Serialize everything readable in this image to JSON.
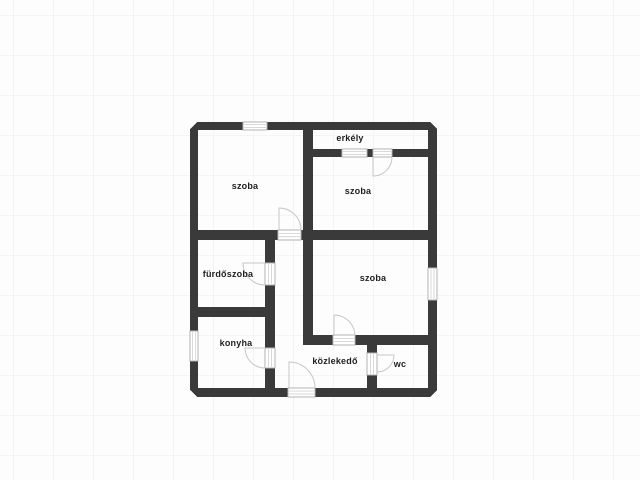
{
  "floor_plan": {
    "rooms": [
      {
        "name": "szoba-top-left",
        "label": "szoba"
      },
      {
        "name": "erkely",
        "label": "erkély"
      },
      {
        "name": "szoba-top-right",
        "label": "szoba"
      },
      {
        "name": "szoba-middle",
        "label": "szoba"
      },
      {
        "name": "furdoszoba",
        "label": "fürdőszoba"
      },
      {
        "name": "konyha",
        "label": "konyha"
      },
      {
        "name": "kozlekedo",
        "label": "közlekedő"
      },
      {
        "name": "wc",
        "label": "wc"
      }
    ],
    "colors": {
      "wall": "#3a3a3a",
      "background": "#fdfdfd",
      "grid_line": "#f4f4f4",
      "door_swing": "#c6c6c6",
      "opening_border": "#b3b3b3",
      "opening_line": "#d9d9d9",
      "label": "#1f1f1f"
    }
  }
}
